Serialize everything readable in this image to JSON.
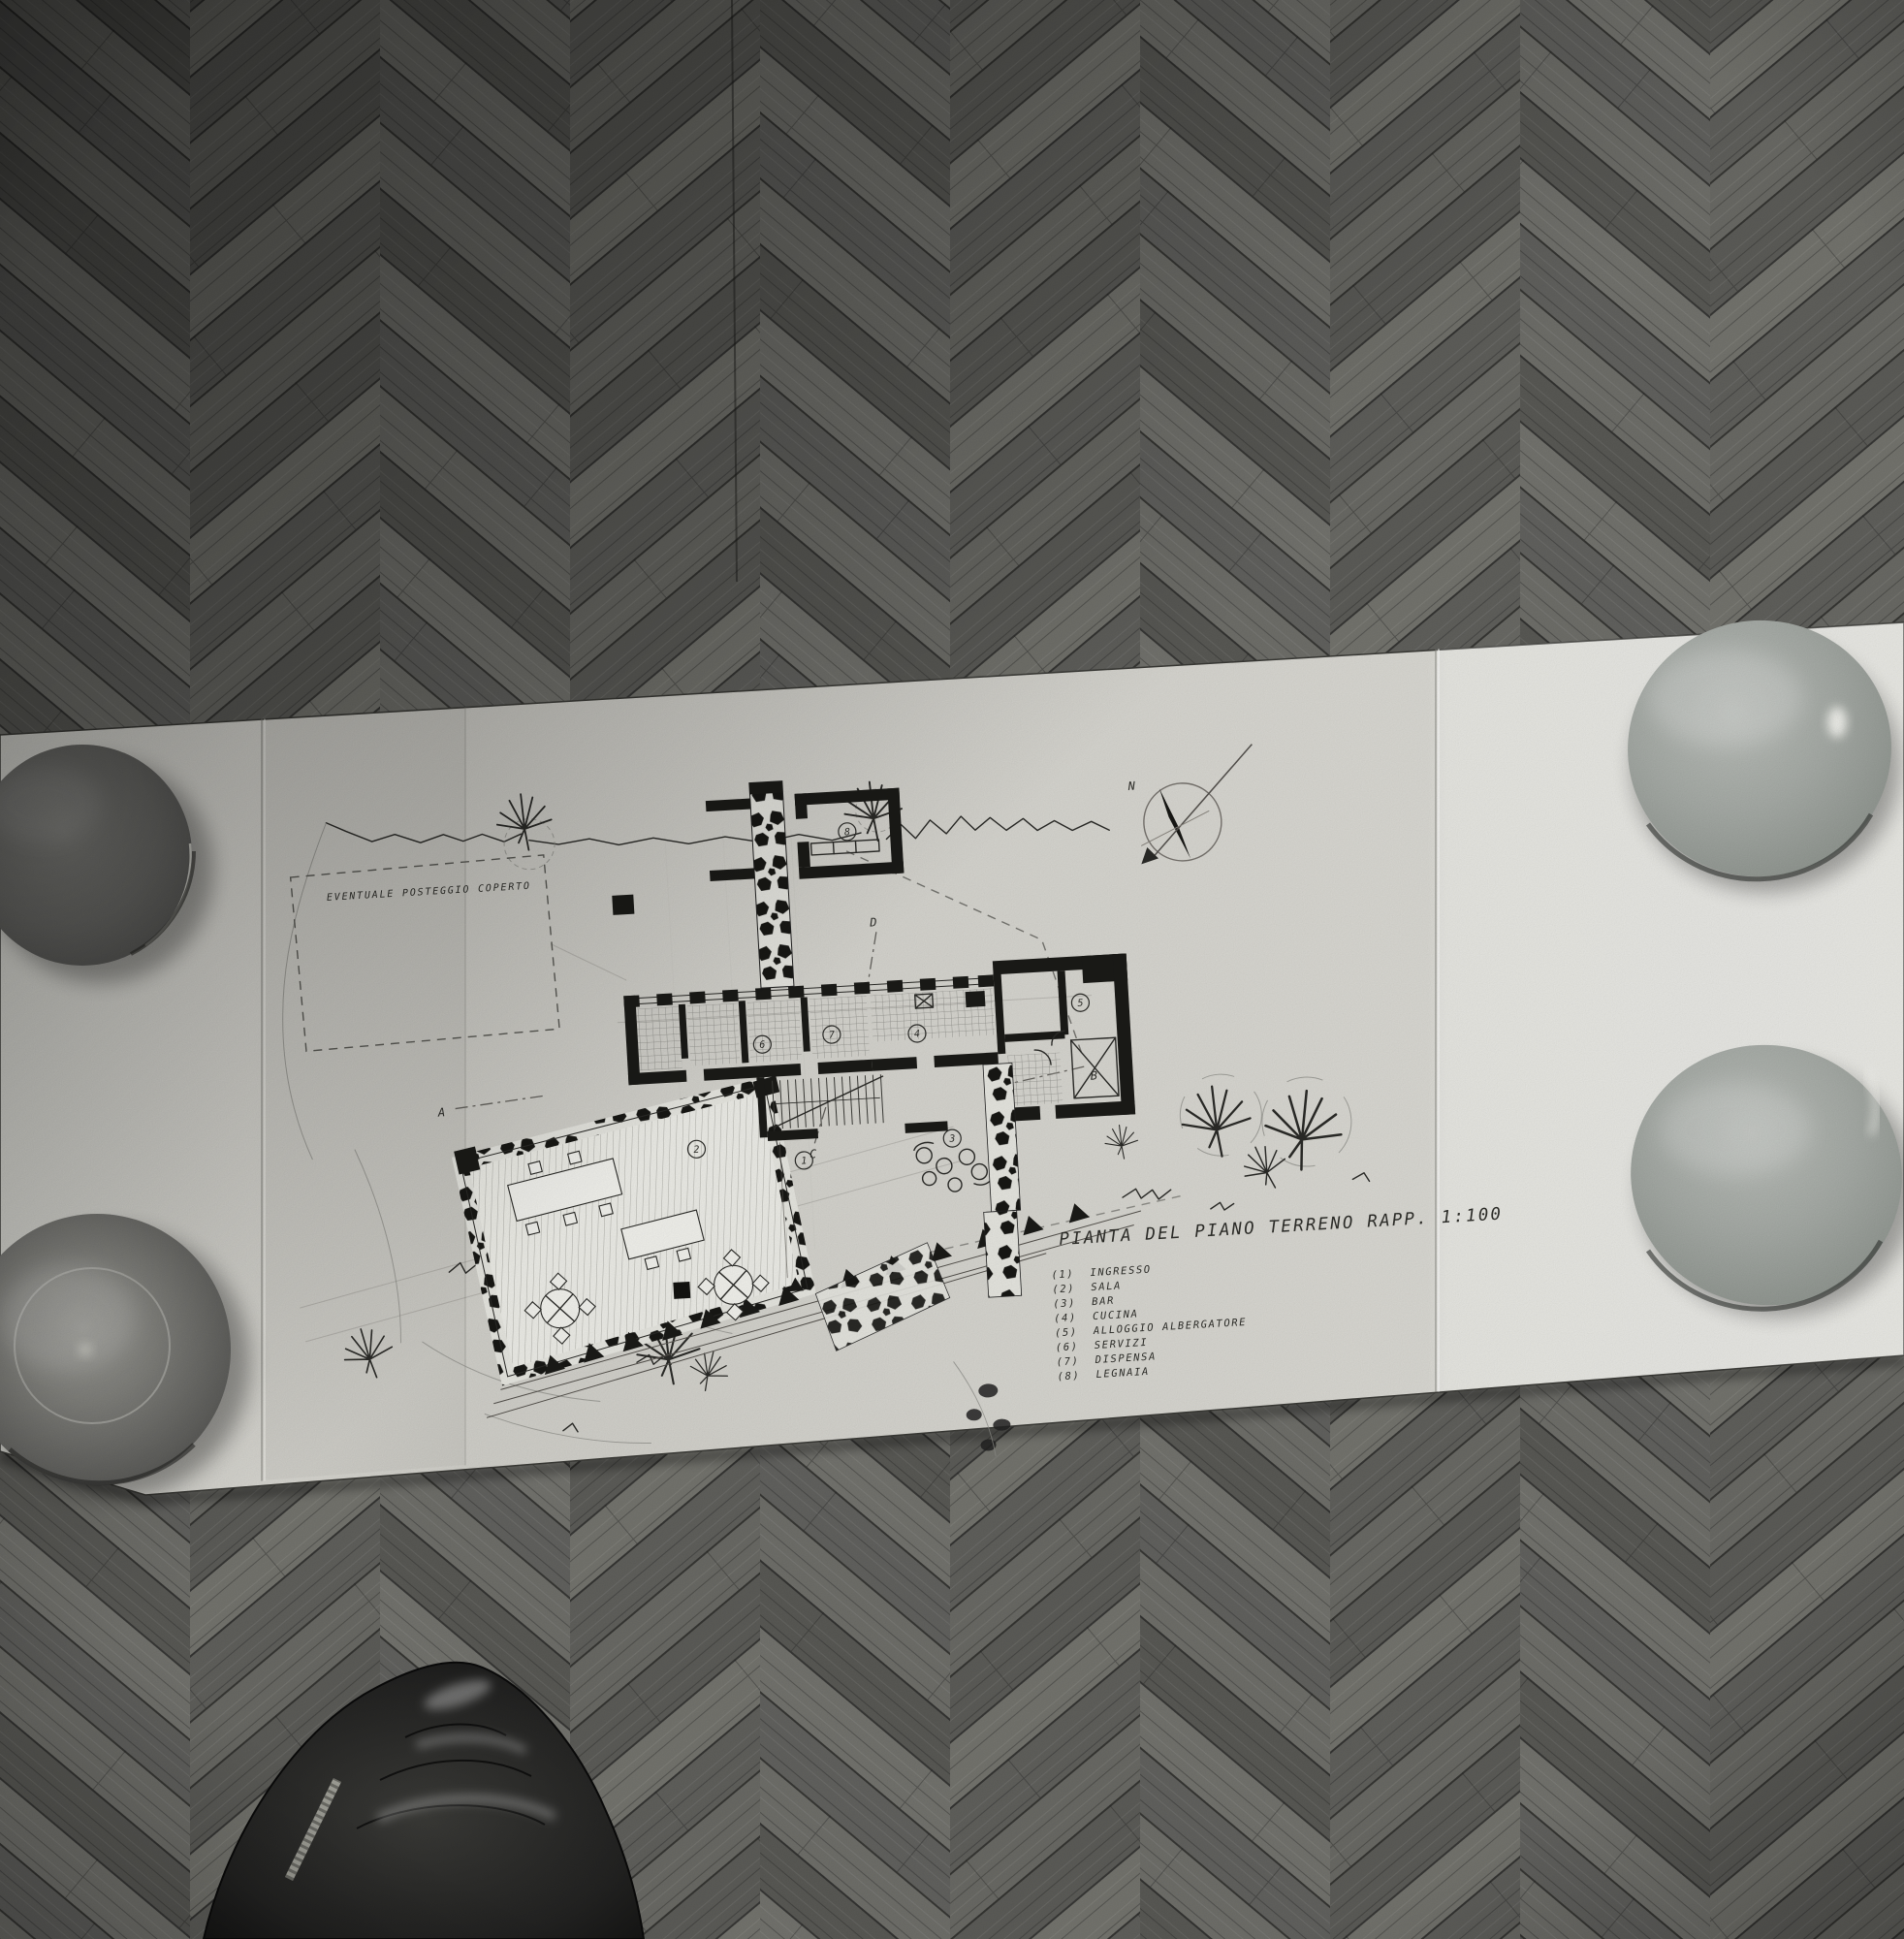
{
  "plan": {
    "title": "PIANTA DEL PIANO TERRENO  RAPP. 1:100",
    "annotation_parking": "EVENTUALE POSTEGGIO COPERTO",
    "compass": {
      "north_label": "N"
    },
    "legend": {
      "items": [
        {
          "num": "(1)",
          "label": "INGRESSO"
        },
        {
          "num": "(2)",
          "label": "SALA"
        },
        {
          "num": "(3)",
          "label": "BAR"
        },
        {
          "num": "(4)",
          "label": "CUCINA"
        },
        {
          "num": "(5)",
          "label": "ALLOGGIO ALBERGATORE"
        },
        {
          "num": "(6)",
          "label": "SERVIZI"
        },
        {
          "num": "(7)",
          "label": "DISPENSA"
        },
        {
          "num": "(8)",
          "label": "LEGNAIA"
        }
      ]
    },
    "room_numbers": [
      {
        "num": "1"
      },
      {
        "num": "2"
      },
      {
        "num": "3"
      },
      {
        "num": "4"
      },
      {
        "num": "5"
      },
      {
        "num": "6"
      },
      {
        "num": "7"
      },
      {
        "num": "8"
      }
    ],
    "section_markers": [
      {
        "label": "A"
      },
      {
        "label": "B"
      },
      {
        "label": "C"
      },
      {
        "label": "D"
      }
    ]
  },
  "colors": {
    "paper": "#d9d8d2",
    "ink": "#2b2b28",
    "floor_mid": "#6a6a66",
    "floor_dark": "#383835",
    "plate_dark": "#5f5f5c",
    "plate_light": "#a9aeaa",
    "shoe": "#161614"
  }
}
